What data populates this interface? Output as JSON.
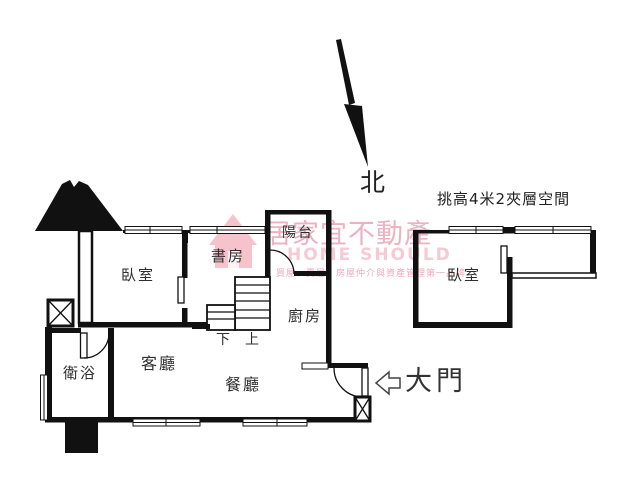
{
  "compass": {
    "label": "北"
  },
  "notes": {
    "mezzanine": "挑高4米2夾層空間"
  },
  "entrance": {
    "label": "大門"
  },
  "rooms": {
    "bedroom": "臥室",
    "study": "書房",
    "balcony": "陽台",
    "kitchen": "廚房",
    "bathroom": "衛浴",
    "living": "客廳",
    "dining": "餐廳",
    "mezzanine_bedroom": "臥室"
  },
  "stairs": {
    "down": "下",
    "up": "上"
  },
  "watermark": {
    "brand_zh": "居家宜不動產",
    "brand_en": "HOME SHOULD",
    "tagline": "買屋、賣屋，房屋仲介與資產管理第一品牌"
  },
  "colors": {
    "line": "#111111",
    "label": "#2e2e2e",
    "watermark_pink": "#eaa9bc",
    "watermark_pink_light": "#f7c9d4"
  }
}
